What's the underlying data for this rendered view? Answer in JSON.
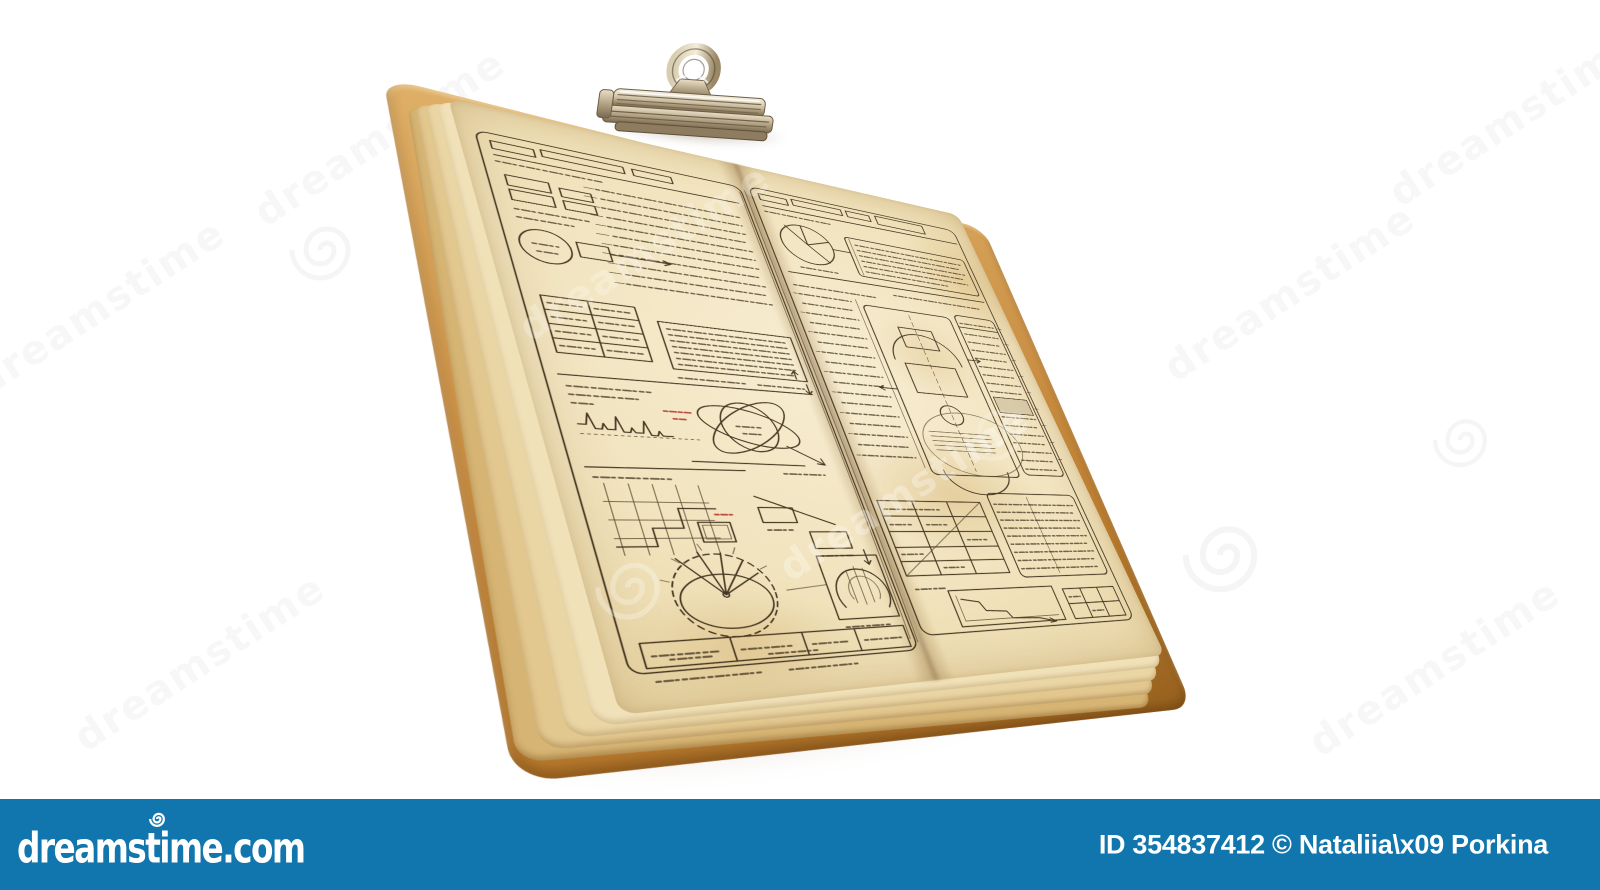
{
  "meta": {
    "kind": "stock-photo-preview",
    "background_color": "#ffffff",
    "subject_alt": "vintage clipboard with metal clip holding a stack of aged yellowed pages covered in hand-drawn technical blueprint sketches"
  },
  "watermark": {
    "text": "dreamstime",
    "spiral_icon": "dreamstime-spiral-icon",
    "tile_color": "rgba(70,70,70,0.05)"
  },
  "clipboard": {
    "paper_color": "#f1e3bd",
    "under_pages_colors": [
      "#f0e1b9",
      "#ead5a5",
      "#e2c78f",
      "#d6b473"
    ],
    "board_color": "#c08a45",
    "sketch_line_color": "#473823",
    "sketch_accent_red": "#b5342a",
    "clip_metal_color": "#cbbda0"
  },
  "footer": {
    "background_color": "#1176ad",
    "text_color": "#ffffff",
    "site": "dreamstime.com",
    "credit": "ID 354837412 © Nataliia\\x09 Porkina"
  }
}
